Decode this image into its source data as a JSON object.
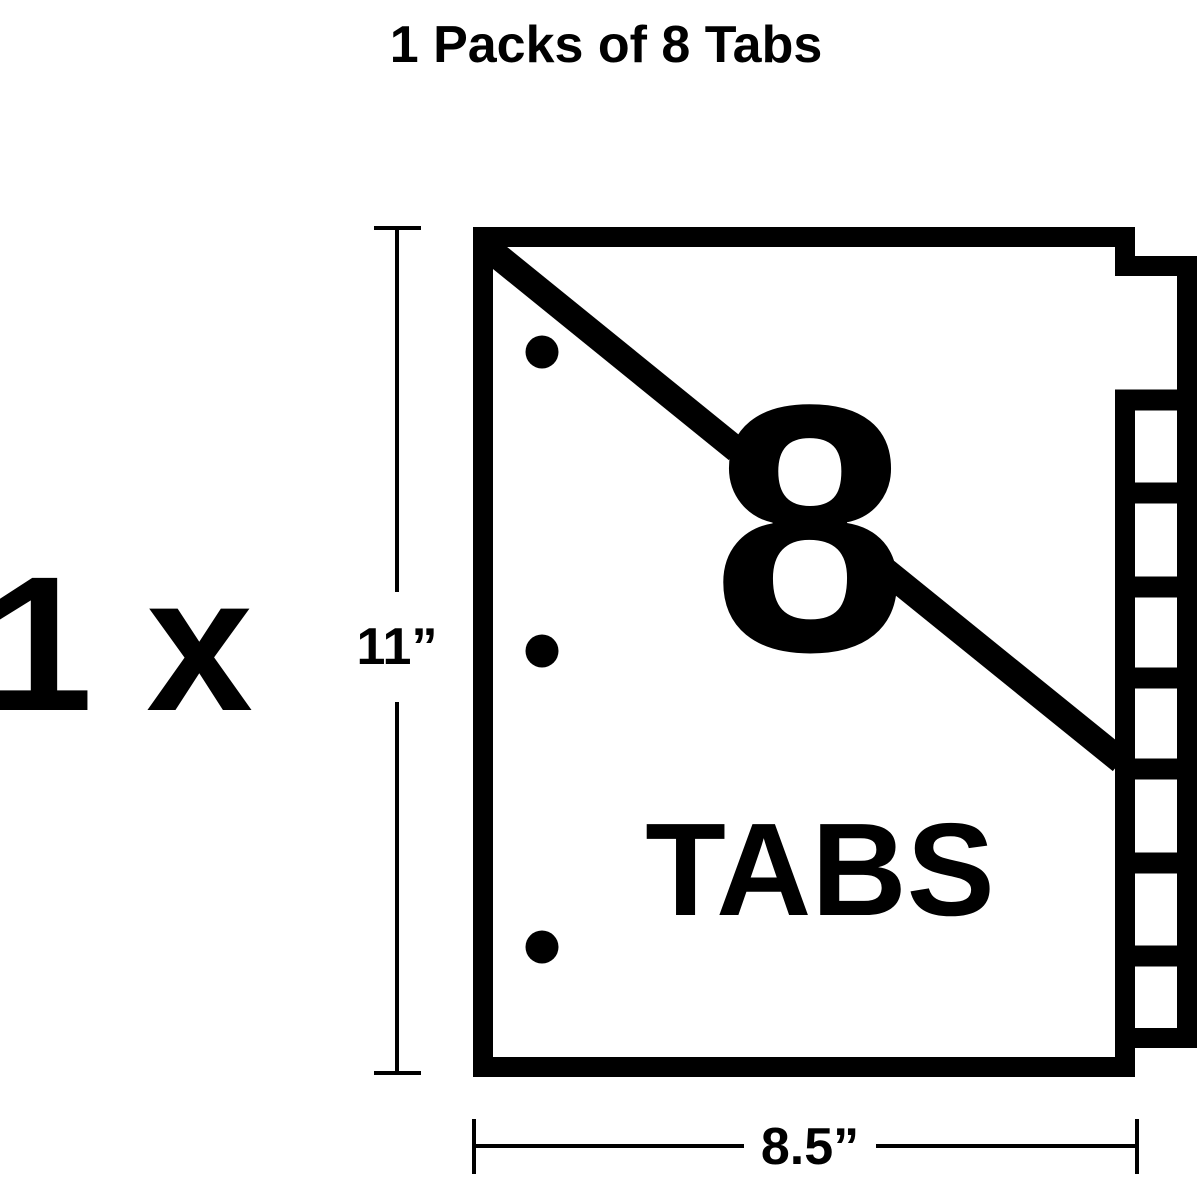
{
  "title": "1 Packs of 8 Tabs",
  "quantity": {
    "label": "1 x"
  },
  "divider": {
    "tab_count_label": "8",
    "tabs_word": "TABS",
    "tab_count": 8
  },
  "dimensions": {
    "height_label": "11”",
    "width_label": "8.5”"
  },
  "colors": {
    "ink": "#000000",
    "background": "#ffffff"
  }
}
